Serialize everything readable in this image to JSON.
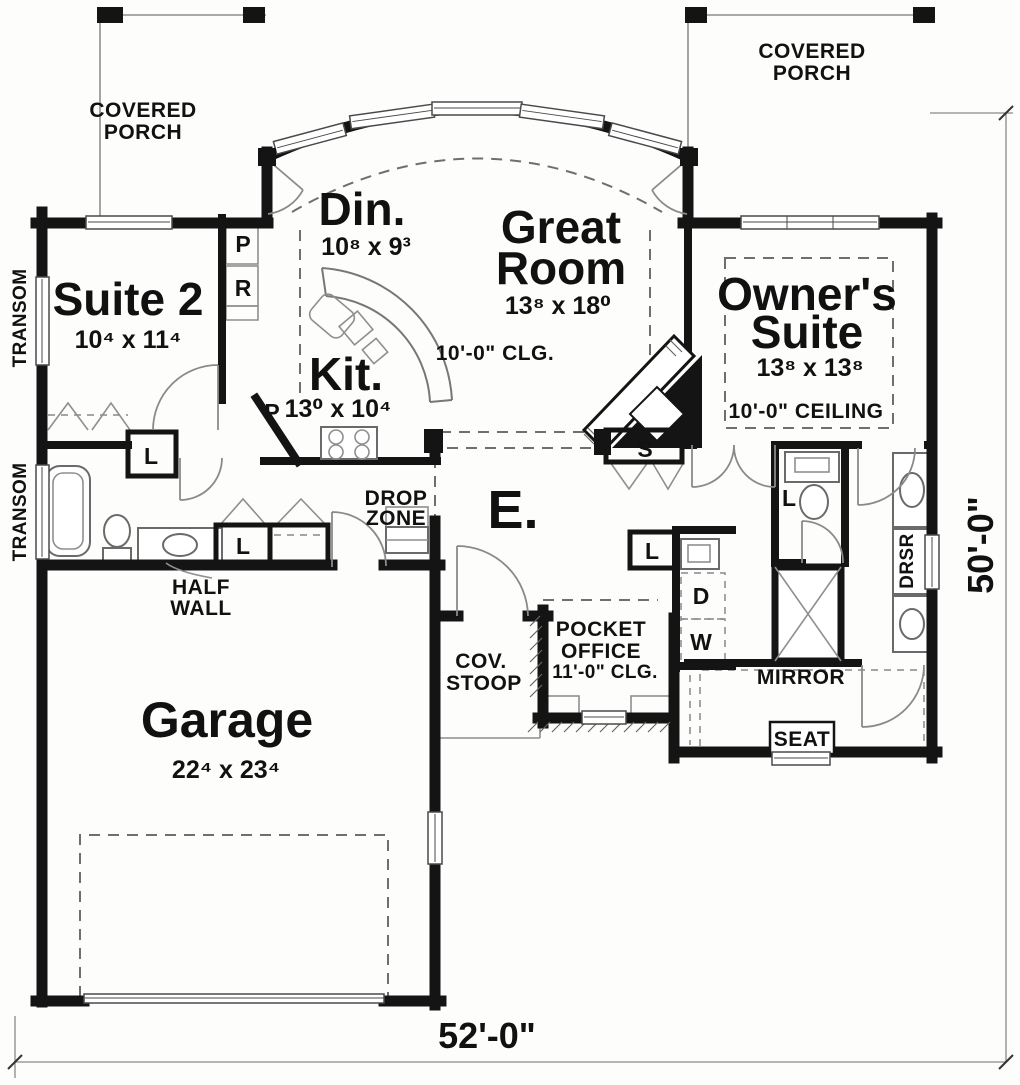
{
  "plan": {
    "porch_left": {
      "l1": "COVERED",
      "l2": "PORCH"
    },
    "porch_right": {
      "l1": "COVERED",
      "l2": "PORCH"
    },
    "suite2": {
      "name": "Suite 2",
      "dims": "10⁴ x 11⁴"
    },
    "dining": {
      "name": "Din.",
      "dims": "10⁸ x 9³"
    },
    "great_room": {
      "l1": "Great",
      "l2": "Room",
      "dims": "13⁸ x 18⁰",
      "ceiling": "10'-0\" CLG."
    },
    "kitchen": {
      "name": "Kit.",
      "dims": "13⁰ x 10⁴"
    },
    "owners_suite": {
      "l1": "Owner's",
      "l2": "Suite",
      "dims": "13⁸ x 13⁸",
      "ceiling": "10'-0\" CEILING"
    },
    "garage": {
      "name": "Garage",
      "dims": "22⁴ x 23⁴"
    },
    "entry": {
      "name": "E."
    },
    "drop_zone": {
      "l1": "DROP",
      "l2": "ZONE"
    },
    "cov_stoop": {
      "l1": "COV.",
      "l2": "STOOP"
    },
    "pocket_office": {
      "l1": "POCKET",
      "l2": "OFFICE",
      "ceiling": "11'-0\" CLG."
    },
    "half_wall": {
      "l1": "HALF",
      "l2": "WALL"
    },
    "labels": {
      "transom": "TRANSOM",
      "mirror": "MIRROR",
      "seat": "SEAT",
      "dresser": "DRSR"
    },
    "letters": {
      "pantry": "P",
      "refrigerator": "R",
      "linen": "L",
      "storage": "S",
      "dryer": "D",
      "washer": "W"
    },
    "dimensions": {
      "width": "52'-0\"",
      "depth": "50'-0\""
    },
    "colors": {
      "wall": "#141414",
      "line": "#8a8a8a",
      "background": "#fdfdfc"
    }
  }
}
